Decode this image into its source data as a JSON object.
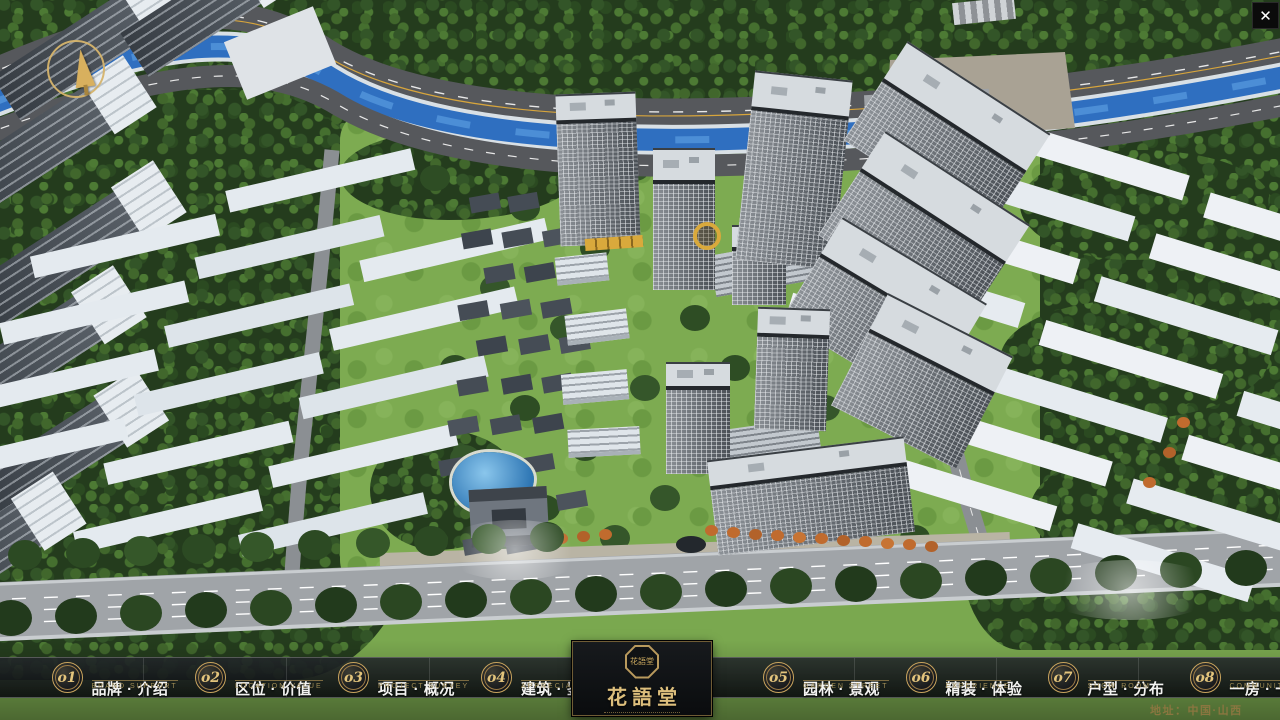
{
  "window": {
    "close_label": "✕"
  },
  "hud": {
    "address": "地址：中国·山西"
  },
  "brand": {
    "name": "花語堂",
    "seal": "花語堂"
  },
  "nav": {
    "items": [
      {
        "num": "o1",
        "zh": "品牌 · 介绍",
        "en": "BRAND SUPPORT"
      },
      {
        "num": "o2",
        "zh": "区位 · 价值",
        "en": "LOCATION VALUE"
      },
      {
        "num": "o3",
        "zh": "项目 · 概况",
        "en": "PROJECT SURVEY"
      },
      {
        "num": "o4",
        "zh": "建筑 · 鉴赏",
        "en": "APPRECIATION"
      },
      {
        "num": "o5",
        "zh": "园林 · 景观",
        "en": "GARDEN STREET"
      },
      {
        "num": "o6",
        "zh": "精装 · 体验",
        "en": "EXPERIENCE"
      },
      {
        "num": "o7",
        "zh": "户型 · 分布",
        "en": "SHOW ROOM"
      },
      {
        "num": "o8",
        "zh": "一房 · 一景",
        "en": "COMMUNITY"
      }
    ]
  },
  "colors": {
    "accent_gold": "#c9a45c",
    "navbar_bg": "rgba(18,21,24,0.88)",
    "river_blue": "#2f6fc0",
    "lawn_green": "#7dab51",
    "road_gray": "#a0a4a8"
  }
}
